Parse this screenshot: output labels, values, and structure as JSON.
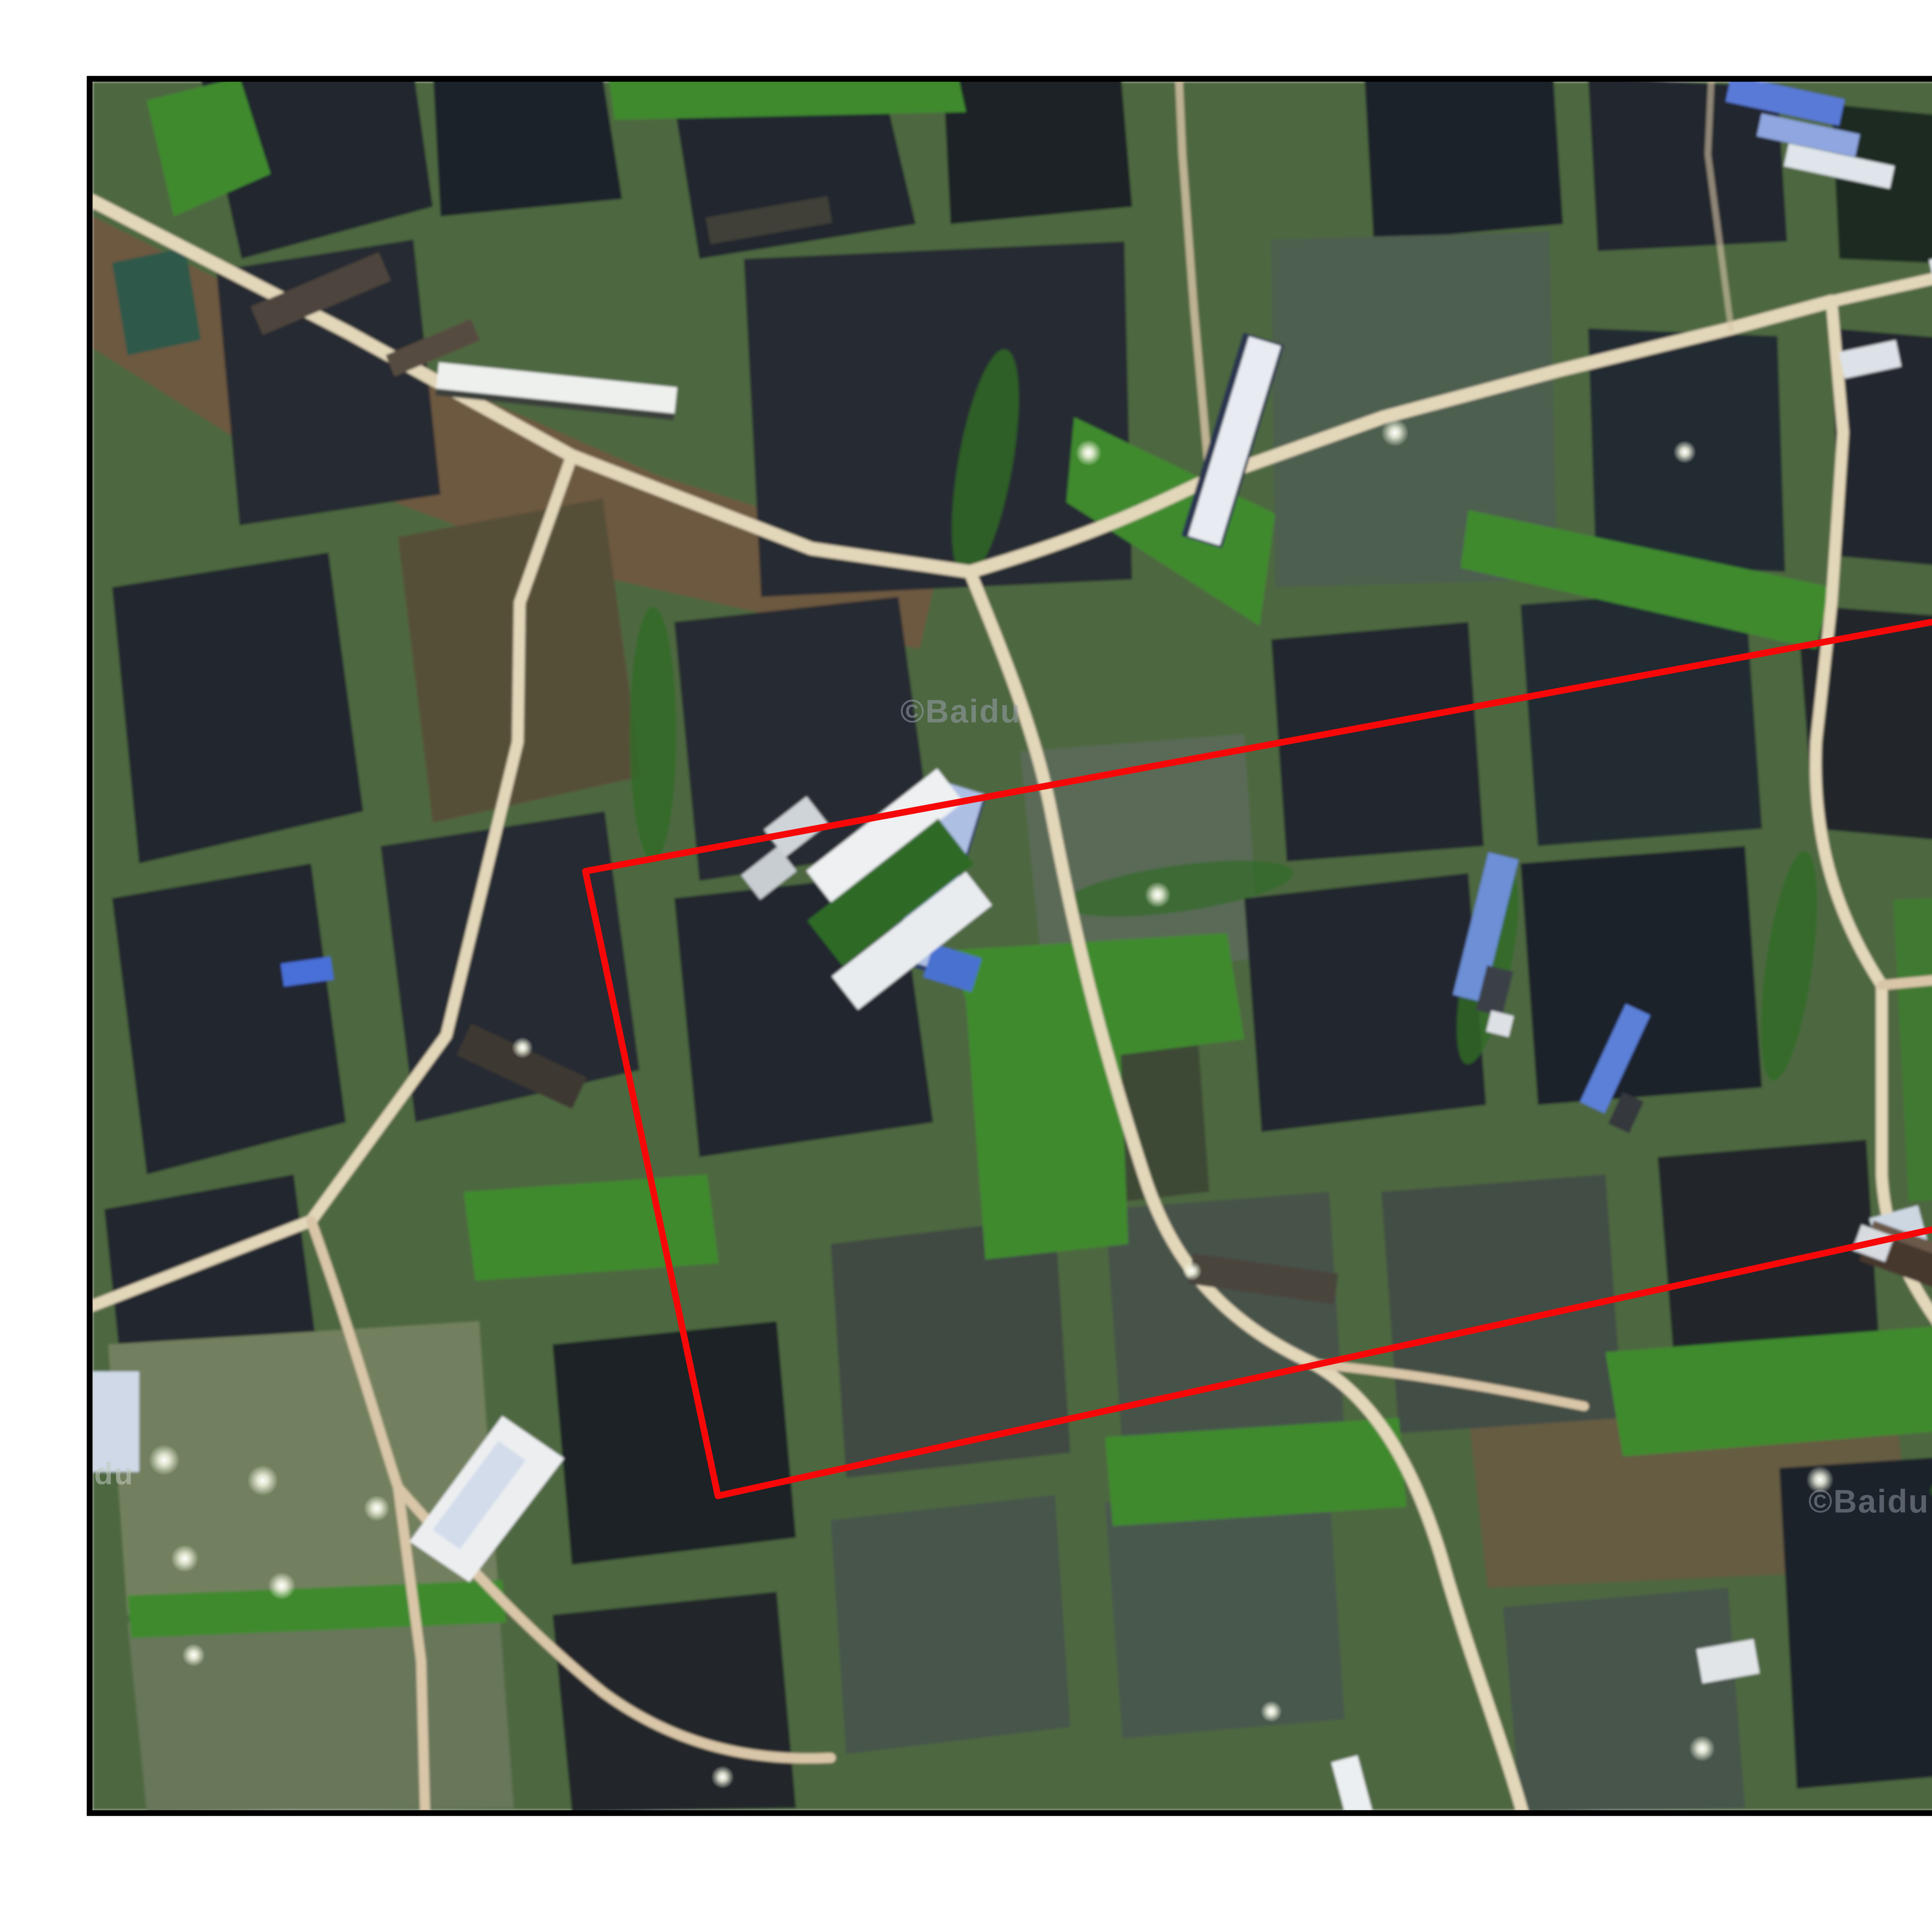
{
  "map": {
    "watermark": "©Baidu",
    "river_label": "大沙河",
    "imagery_type": "satellite photo of aquaculture fish ponds"
  },
  "colors": {
    "page_background": "#ffffff",
    "frame_black": "#000000",
    "red_outline": "#f70808",
    "river_water": "#31453f",
    "pond_dark": "#20252d",
    "pond_green": "#5a6a57",
    "vegetation_base": "#4d6741",
    "vegetation_bright": "#3f8a2f",
    "road_tan": "#e3d7ba",
    "roof_blue": "#3f63d8",
    "roof_white": "#eceff1",
    "watermark_gray": "#98a0ac",
    "river_label_blue": "#2f6fe0"
  },
  "roi": {
    "shape": "rotated rounded rectangle",
    "stroke_width": 17,
    "corner_points": [
      [
        1515,
        2255
      ],
      [
        5287,
        1557
      ],
      [
        5452,
        2800
      ],
      [
        1858,
        3872
      ]
    ],
    "rounded_corner": "bottom-right"
  }
}
